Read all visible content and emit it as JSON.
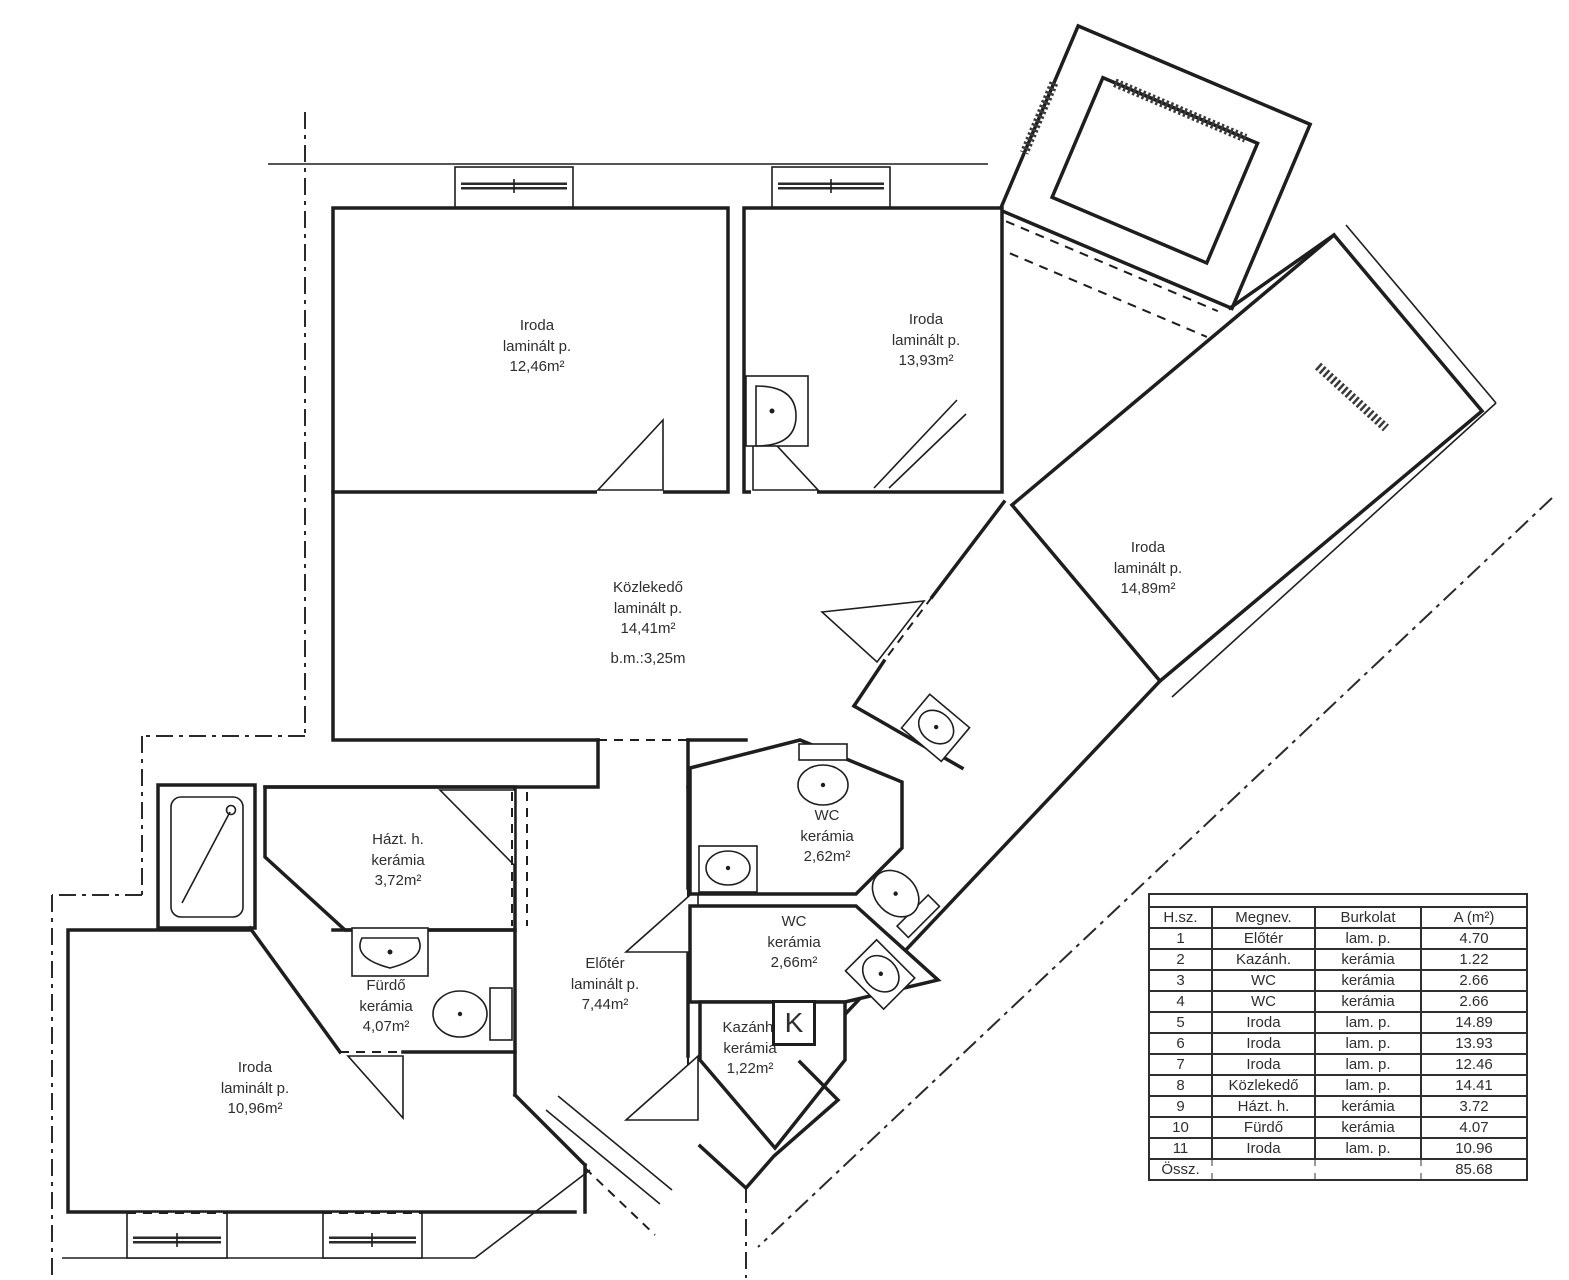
{
  "rooms": [
    {
      "name": "Iroda",
      "floor": "laminált p.",
      "area": "12,46m²"
    },
    {
      "name": "Iroda",
      "floor": "laminált p.",
      "area": "13,93m²"
    },
    {
      "name": "Iroda",
      "floor": "laminált p.",
      "area": "14,89m²"
    },
    {
      "name": "Közlekedő",
      "floor": "laminált p.",
      "area": "14,41m²"
    },
    {
      "name": "Házt. h.",
      "floor": "kerámia",
      "area": "3,72m²"
    },
    {
      "name": "WC",
      "floor": "kerámia",
      "area": "2,62m²"
    },
    {
      "name": "WC",
      "floor": "kerámia",
      "area": "2,66m²"
    },
    {
      "name": "Előtér",
      "floor": "laminált p.",
      "area": "7,44m²"
    },
    {
      "name": "Fürdő",
      "floor": "kerámia",
      "area": "4,07m²"
    },
    {
      "name": "Kazánh.",
      "floor": "kerámia",
      "area": "1,22m²"
    },
    {
      "name": "Iroda",
      "floor": "laminált p.",
      "area": "10,96m²"
    }
  ],
  "corridor_note": "b.m.:3,25m",
  "boiler_symbol": "K",
  "legend_table": {
    "headers": [
      "H.sz.",
      "Megnev.",
      "Burkolat",
      "A (m²)"
    ],
    "rows": [
      [
        "1",
        "Előtér",
        "lam. p.",
        "4.70"
      ],
      [
        "2",
        "Kazánh.",
        "kerámia",
        "1.22"
      ],
      [
        "3",
        "WC",
        "kerámia",
        "2.66"
      ],
      [
        "4",
        "WC",
        "kerámia",
        "2.66"
      ],
      [
        "5",
        "Iroda",
        "lam. p.",
        "14.89"
      ],
      [
        "6",
        "Iroda",
        "lam. p.",
        "13.93"
      ],
      [
        "7",
        "Iroda",
        "lam. p.",
        "12.46"
      ],
      [
        "8",
        "Közlekedő",
        "lam. p.",
        "14.41"
      ],
      [
        "9",
        "Házt. h.",
        "kerámia",
        "3.72"
      ],
      [
        "10",
        "Fürdő",
        "kerámia",
        "4.07"
      ],
      [
        "11",
        "Iroda",
        "lam. p.",
        "10.96"
      ]
    ],
    "total_label": "Össz.",
    "total_value": "85.68"
  },
  "colors": {
    "line": "#1e1e1e",
    "background": "#ffffff",
    "faded_total": "#bfbfbf"
  }
}
